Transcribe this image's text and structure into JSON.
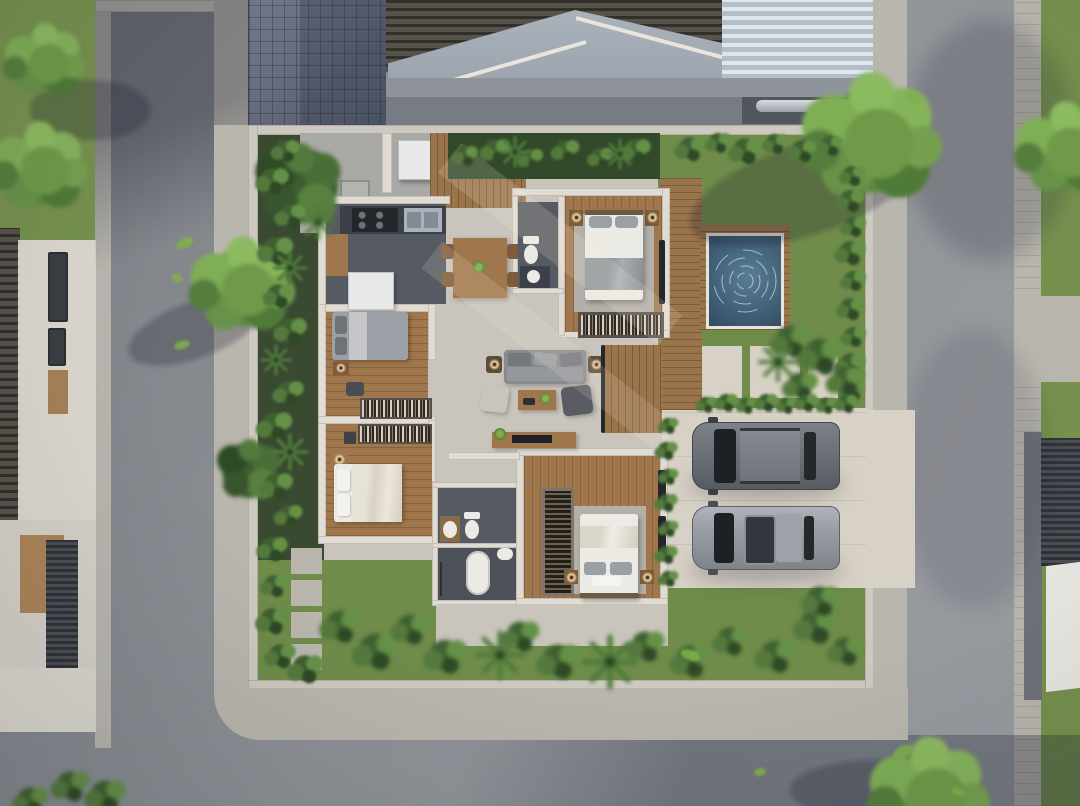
{
  "meta": {
    "type": "aerial-3d-architectural-render",
    "view": "top-down dollhouse cutaway of a modern single-storey villa",
    "canvas": {
      "width": 1080,
      "height": 806
    },
    "visible_text": "none"
  },
  "palette": {
    "asphalt": "#8e9196",
    "sidewalk": "#b9b6ae",
    "grass": "#76914e",
    "grass_yard": "#6f8c4a",
    "foliage_dark": "#33502c",
    "foliage_mid": "#4e7238",
    "foliage_light": "#7ba352",
    "brick_pave": "#687083",
    "gable_roof": "#a3abb5",
    "ridge_white": "#e9e5dc",
    "corrugated": "#b4bec9",
    "corrugated_rib": "#dfe6ec",
    "wall_top": "#cdc9c0",
    "wall_light": "#e0dcd3",
    "concrete_floor": "#c9c5bd",
    "concrete_lit": "#d8d2c6",
    "wood_floor": "#a0774c",
    "deck_wood": "#9a744b",
    "dark_tile_floor": "#565b63",
    "counter_dark": "#3c4149",
    "stainless": "#aab2bb",
    "white_goods": "#e6e8ea",
    "pool_water": "#47687f",
    "pool_deep": "#2f4a63",
    "bed_white": "#eceae4",
    "bed_gray": "#9aa0a6",
    "sofa_gray": "#878b90",
    "rug_gray": "#b3b0a9",
    "car_dark": "#70757b",
    "car_light": "#989da3",
    "glass_dark": "#23262b",
    "lamp_glow": "#f3d9a8",
    "shadow": "rgba(33,38,50,0.30)"
  },
  "scene": {
    "streets": {
      "left_road": "asphalt street running vertically, long diagonal shade at top",
      "bottom_road": "asphalt street running horizontally, shaded on right half",
      "right_road": "asphalt street running vertically with dappled tree shadows",
      "sidewalks": "light concrete curbs and paver strips around the block"
    },
    "neighbors": {
      "top_building": {
        "roofs": [
          "dark clay tile roof",
          "light gray gable roof with white ridge trim",
          "white corrugated metal roof"
        ],
        "ground": "blue-gray herringbone brick driveway, dark garage slot with parked car glimpse"
      },
      "left_house": [
        "dark tile roof strip",
        "white walls",
        "dark framed windows",
        "wood door",
        "dark louvered pergola"
      ],
      "right_house": [
        "dark louvered roof",
        "white awning",
        "concrete side wall"
      ]
    },
    "plot": {
      "boundary": "light concrete perimeter wall",
      "gardens": [
        "left planting strip with tropical plants and 4 stepping stones",
        "top-right lawn with hedge rows and corner shrub mass",
        "south lawn with dense shrubs and palms"
      ],
      "pool": {
        "shape": "square plunge pool",
        "water": "deep blue with white ripple rings",
        "surround": "wood deck"
      },
      "deck": "wood boardwalk along the entry and down the east side of the house",
      "driveway": {
        "surface": "concrete with seams",
        "opens_to": "right road",
        "vehicle_count": 2
      },
      "path": "concrete pads with planted joints linking driveway to deck",
      "vehicles": [
        {
          "name": "suv-dark-gray",
          "facing": "west",
          "details": [
            "black windshield",
            "roof rails"
          ]
        },
        {
          "name": "suv-light-gray",
          "facing": "west",
          "details": [
            "dark panoramic sunroof",
            "roof rails"
          ]
        }
      ]
    },
    "house": {
      "rooms": [
        {
          "name": "utility-patio",
          "floor": "concrete",
          "items": [
            "washing machine",
            "floor hatch",
            "wood gate"
          ]
        },
        {
          "name": "kitchen",
          "floor": "dark tile",
          "items": [
            "L-shaped dark counter",
            "4-burner cooktop",
            "double stainless sink",
            "refrigerator",
            "wood cabinet"
          ]
        },
        {
          "name": "dining-area",
          "floor": "concrete",
          "items": [
            "wood dining table",
            "4 chairs",
            "small table plant"
          ]
        },
        {
          "name": "ensuite-bathroom",
          "floor": "dark tile",
          "items": [
            "toilet",
            "round-basin vanity"
          ]
        },
        {
          "name": "master-bedroom",
          "floor": "wood",
          "items": [
            "double bed",
            "2 lamp nightstands",
            "gray rug",
            "slatted wardrobe with books"
          ]
        },
        {
          "name": "living-room",
          "floor": "concrete",
          "items": [
            "gray sofa",
            "2 lamp side tables",
            "wood coffee table with plant",
            "light armchair",
            "dark armchair",
            "tv console"
          ]
        },
        {
          "name": "bedroom-2",
          "floor": "wood",
          "items": [
            "double bed gray bedding",
            "nightstand",
            "dark ottoman",
            "bookshelf"
          ]
        },
        {
          "name": "bedroom-3",
          "floor": "wood",
          "items": [
            "double bed cream bedding",
            "lamp nightstand",
            "slatted wardrobe"
          ]
        },
        {
          "name": "main-bathroom",
          "floor": "dark tile",
          "items": [
            "toilet",
            "bowl-sink vanity",
            "bathtub",
            "second basin",
            "shower corner"
          ]
        },
        {
          "name": "bedroom-4",
          "floor": "wood",
          "items": [
            "double bed white bedding",
            "2 lamp nightstands",
            "tall slatted wardrobe",
            "garden windows"
          ]
        }
      ]
    },
    "vegetation": {
      "trees": 8,
      "shrub_clusters": "along walls, hedge above driveway, south garden masses",
      "floating_leaves": 8
    },
    "lighting": {
      "sun": "warm afternoon light from upper right",
      "shadows": "long soft diagonal shadows across roads and floors"
    }
  }
}
